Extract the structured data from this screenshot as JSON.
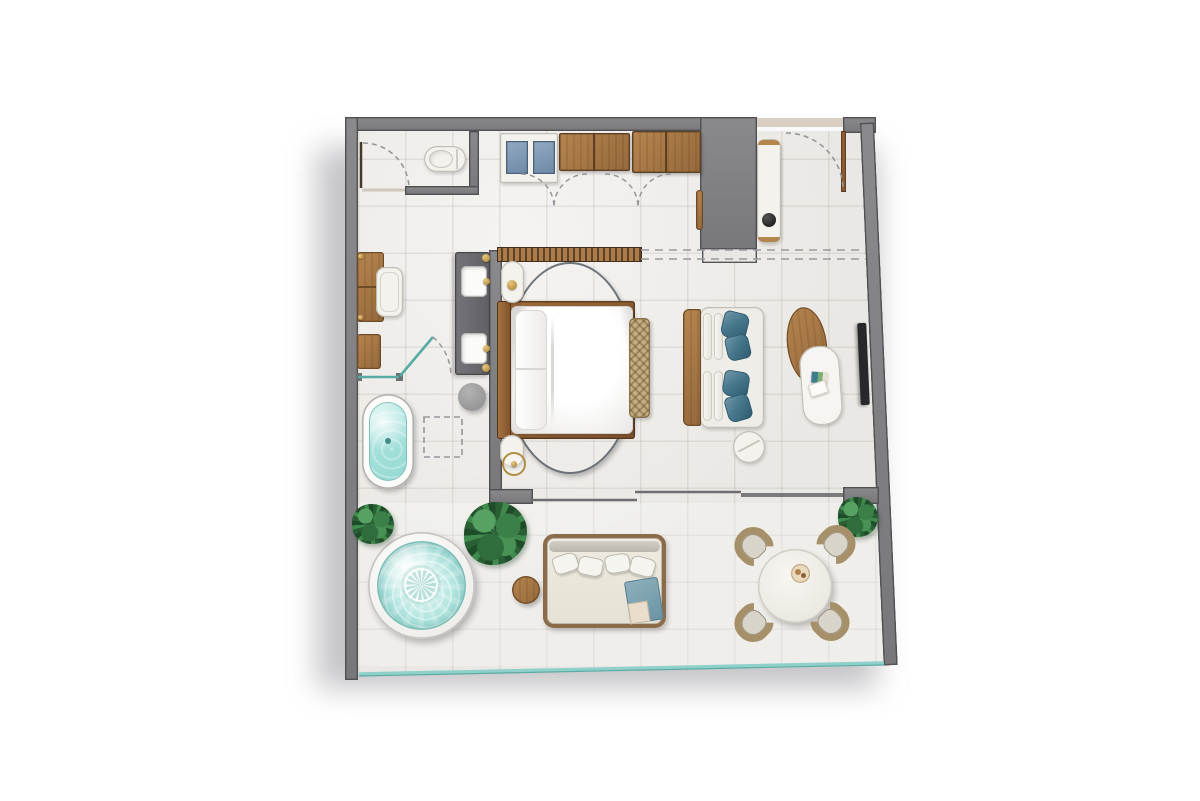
{
  "meta": {
    "title": "Hotel Suite Floor Plan — Top-Down Render",
    "type": "architectural floor plan, one-bedroom suite with terrace",
    "canvas": {
      "width": 1200,
      "height": 801
    }
  },
  "palette": {
    "background": "#ffffff",
    "wall_gray": "#7f7f82",
    "wall_outline": "#515154",
    "floor_tile": "#eae8e4",
    "grout": "#d9d7d3",
    "wood": "#b5854e",
    "wood_dark": "#8a5f33",
    "slat_wood": "#ab7c49",
    "rug_navy": "#32465a",
    "water_turquoise": "#aee6e1",
    "pool_caustic": "#eefaf8",
    "pillow_teal": "#47788d",
    "drawer_blue": "#7e98b4",
    "glass": "#55aca4",
    "glass_light": "#8fd0ca",
    "dash": "#97979a",
    "slider": "#6e6e71",
    "door_leaf": "#4a3826",
    "brass": "#b08d3f",
    "linen_white": "#f4f2ed",
    "woven_tan": "#c6ae80",
    "plant_green": "#3f8a4c",
    "tv_black": "#28282a"
  },
  "rooms": [
    {
      "name": "wc",
      "label": "WC",
      "furniture": [
        "toilet",
        "hinged-door-with-swing-arc"
      ]
    },
    {
      "name": "walk-in-closet",
      "label": "Closet / Dressing",
      "furniture": [
        "drawer-unit-2-blue-drawers",
        "wardrobe-cabinet-left",
        "wardrobe-cabinet-right",
        "four-door-swing-arcs",
        "slatted-headboard-feature-wall"
      ]
    },
    {
      "name": "entry-hall",
      "label": "Entry Hall",
      "furniture": [
        "entry-door-with-swing-arc",
        "console-table",
        "black-decor-bowl",
        "wall-column",
        "threshold",
        "ceiling-track-dashed"
      ]
    },
    {
      "name": "bedroom",
      "label": "Bedroom",
      "furniture": [
        "king-bed-white-duvet",
        "wood-platform-headboard",
        "pillows",
        "foot-bench-woven",
        "round-navy-rug",
        "nightstand-north",
        "nightstand-south",
        "table-lamp",
        "floor-lamp"
      ]
    },
    {
      "name": "bathroom",
      "label": "Bathroom / Dressing Area",
      "furniture": [
        "double-sink-stone-vanity",
        "brass-sconces",
        "freestanding-oval-bathtub",
        "walk-in-shower-dashed",
        "gray-stool",
        "glass-partition",
        "pivot-glass-door",
        "writing-desk",
        "desk-chair",
        "luggage-bench"
      ]
    },
    {
      "name": "living-room",
      "label": "Living Room",
      "furniture": [
        "lounge-sofa-wood-back",
        "bolster-cushions",
        "teal-accent-pillows-x4",
        "round-side-table",
        "oval-wood-coffee-table",
        "oval-white-coffee-table",
        "magazines",
        "wall-mounted-tv",
        "sliding-glass-door"
      ]
    },
    {
      "name": "terrace",
      "label": "Terrace",
      "furniture": [
        "round-plunge-pool",
        "mosaic-pool-medallion",
        "potted-plant-small",
        "potted-plant-monstera",
        "potted-plant-dining",
        "round-wood-side-table",
        "daybed-with-pillows",
        "blue-towel",
        "round-dining-table",
        "serving-tray",
        "woven-dining-chair-x4",
        "glass-railing"
      ]
    }
  ],
  "counts": {
    "dining_chairs": 4,
    "sofa_pillows": 4,
    "daybed_pillows": 4,
    "sinks": 2,
    "plants": 3,
    "wardrobe_arcs": 4
  }
}
